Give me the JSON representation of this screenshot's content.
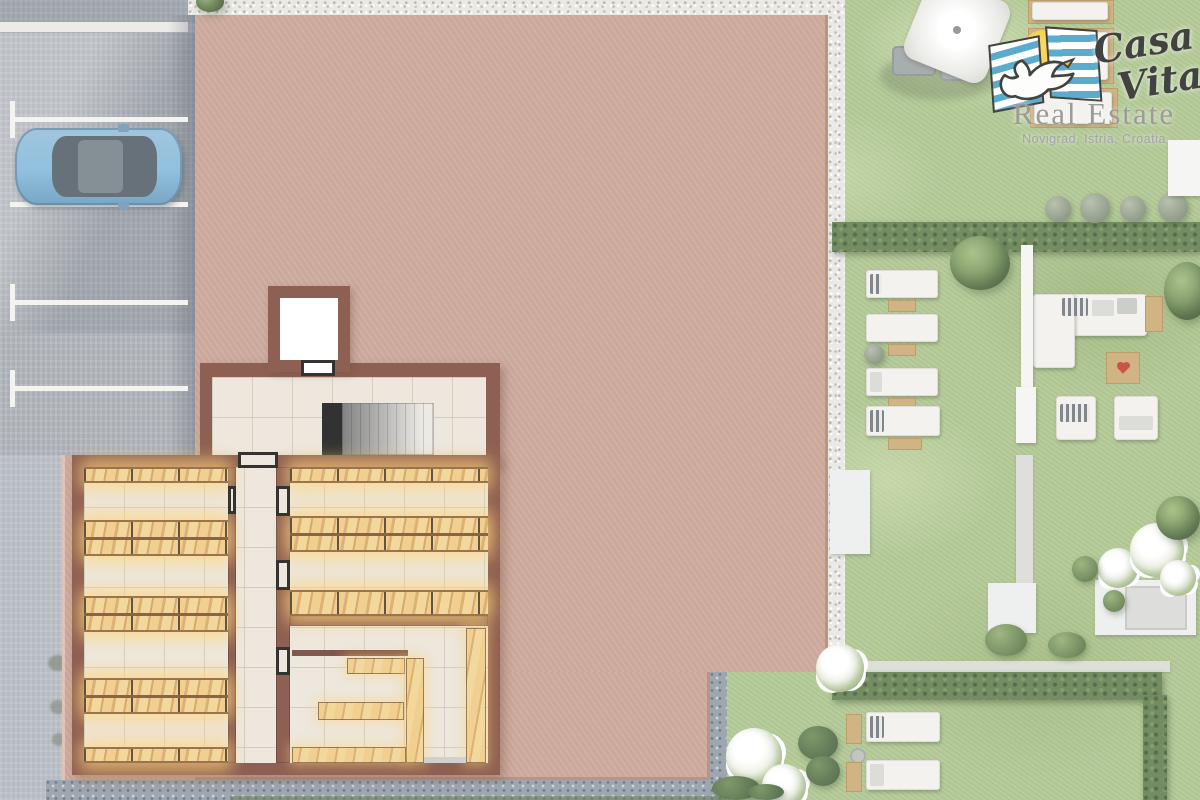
{
  "logo": {
    "brand_line1": "Casa",
    "brand_line2": "Vita",
    "subtitle": "Real Estate",
    "location": "Novigrad, Istria, Croatia"
  },
  "colors": {
    "pavement": "#a7adb4",
    "parking_line": "#f2f1ed",
    "car_body": "#7fb7d9",
    "car_glass": "#4f5a64",
    "roof_plate": "#c79e90",
    "wall_brown": "#7c4637",
    "tile": "#eae4d9",
    "wood_light": "#eec87f",
    "wood_dark": "#d7a55e",
    "glow": "#ffd383",
    "grass": "#a9c287",
    "hedge": "#5d7a49",
    "gravel_white": "#e7e6e1",
    "gravel_blue": "#8e99a4",
    "furniture_white": "#f1f0ec",
    "wood_furniture": "#c9a86f",
    "stone_path": "#d9dad4",
    "logo_text": "#232321",
    "logo_gray": "#8b8b87",
    "flag_blue": "#3f9ec4",
    "sun_yellow": "#f2c832",
    "heart_red": "#c0392b"
  }
}
